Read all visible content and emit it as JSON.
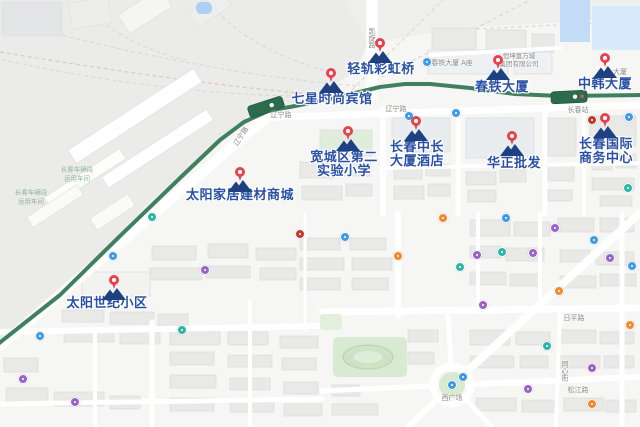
{
  "map": {
    "colors": {
      "poi_label": "#2a51a4",
      "pin_red": "#e8414d",
      "pin_navy": "#1e4182",
      "transit_line": "#41805f",
      "station_fill": "#2c6b4e",
      "water": "#c3dcf5",
      "park": "#d9ead2",
      "road_label": "#8b8b8b",
      "rail_area_label": "#8fb3a6",
      "dot_blue": "#3f9ce2",
      "dot_purple": "#9a63c9",
      "dot_teal": "#2cb6a5",
      "dot_orange": "#ef8a2e",
      "dot_red": "#c0392b"
    },
    "major_pois": [
      {
        "id": "light-rail-rainbow-bridge",
        "lines": [
          "轻轨彩虹桥"
        ],
        "pin": {
          "x": 380,
          "y": 51
        },
        "label": {
          "x": 381,
          "y": 62
        }
      },
      {
        "id": "chuntie-mansion",
        "lines": [
          "春铁大厦"
        ],
        "pin": {
          "x": 498,
          "y": 68
        },
        "label": {
          "x": 502,
          "y": 80
        }
      },
      {
        "id": "zhonghan-mansion",
        "lines": [
          "中韩大厦"
        ],
        "pin": {
          "x": 605,
          "y": 66
        },
        "label": {
          "x": 605,
          "y": 77
        }
      },
      {
        "id": "seven-star-fashion-hotel",
        "lines": [
          "七星时尚宾馆"
        ],
        "pin": {
          "x": 331,
          "y": 81
        },
        "label": {
          "x": 332,
          "y": 92
        }
      },
      {
        "id": "kuancheng-no2-experimental-primary-school",
        "lines": [
          "宽城区第二",
          "实验小学"
        ],
        "pin": {
          "x": 348,
          "y": 139
        },
        "label": {
          "x": 344,
          "y": 150
        }
      },
      {
        "id": "changchun-zhongchang-mansion-hotel",
        "lines": [
          "长春中长",
          "大厦酒店"
        ],
        "pin": {
          "x": 416,
          "y": 129
        },
        "label": {
          "x": 417,
          "y": 140
        }
      },
      {
        "id": "huazheng-wholesale",
        "lines": [
          "华正批发"
        ],
        "pin": {
          "x": 512,
          "y": 144
        },
        "label": {
          "x": 514,
          "y": 156
        }
      },
      {
        "id": "changchun-international-business-center",
        "lines": [
          "长春国际",
          "商务中心"
        ],
        "pin": {
          "x": 605,
          "y": 126
        },
        "label": {
          "x": 606,
          "y": 137
        }
      },
      {
        "id": "taiyang-home-building-materials-mall",
        "lines": [
          "太阳家居建材商城"
        ],
        "pin": {
          "x": 240,
          "y": 180
        },
        "label": {
          "x": 240,
          "y": 188
        }
      },
      {
        "id": "taiyang-century-community",
        "lines": [
          "太阳世纪小区"
        ],
        "pin": {
          "x": 114,
          "y": 288
        },
        "label": {
          "x": 107,
          "y": 296
        }
      }
    ],
    "minor_labels": [
      {
        "text": "辽宁路",
        "x": 281,
        "y": 116
      },
      {
        "text": "辽宁路",
        "x": 242,
        "y": 137,
        "rot": -57
      },
      {
        "text": "辽宁路",
        "x": 396,
        "y": 110
      },
      {
        "text": "凯旋路",
        "x": 371,
        "y": 38,
        "vertical": true
      },
      {
        "text": "长春站",
        "x": 578,
        "y": 111
      },
      {
        "text": "春铁大厦 A座",
        "x": 452,
        "y": 64
      },
      {
        "text": "大厦",
        "x": 620,
        "y": 73
      },
      {
        "text": "西广场",
        "x": 452,
        "y": 399
      },
      {
        "text": "松江路",
        "x": 578,
        "y": 391
      },
      {
        "text": "同心街",
        "x": 564,
        "y": 371,
        "vertical": true
      },
      {
        "text": "日平路",
        "x": 574,
        "y": 319
      },
      {
        "text": "恒坤富万城",
        "x": 519,
        "y": 57,
        "size": 6.5
      },
      {
        "text": "集团有限公司",
        "x": 519,
        "y": 65,
        "size": 6.5
      }
    ],
    "area_labels": [
      {
        "text": "长春车辆段",
        "x": 77,
        "y": 170
      },
      {
        "text": "运用车间",
        "x": 77,
        "y": 179
      },
      {
        "text": "长春车辆段",
        "x": 31,
        "y": 193
      },
      {
        "text": "运用车间",
        "x": 31,
        "y": 202
      }
    ],
    "minor_pois": [
      {
        "color": "dot_blue",
        "x": 427,
        "y": 62
      },
      {
        "color": "dot_blue",
        "x": 409,
        "y": 116
      },
      {
        "color": "dot_blue",
        "x": 456,
        "y": 113
      },
      {
        "color": "dot_blue",
        "x": 629,
        "y": 117
      },
      {
        "color": "dot_blue",
        "x": 113,
        "y": 256
      },
      {
        "color": "dot_blue",
        "x": 40,
        "y": 336
      },
      {
        "color": "dot_blue",
        "x": 345,
        "y": 237
      },
      {
        "color": "dot_blue",
        "x": 506,
        "y": 218
      },
      {
        "color": "dot_blue",
        "x": 594,
        "y": 240
      },
      {
        "color": "dot_blue",
        "x": 632,
        "y": 266
      },
      {
        "color": "dot_blue",
        "x": 463,
        "y": 377
      },
      {
        "color": "dot_blue",
        "x": 452,
        "y": 385
      },
      {
        "color": "dot_purple",
        "x": 205,
        "y": 270
      },
      {
        "color": "dot_purple",
        "x": 23,
        "y": 379
      },
      {
        "color": "dot_purple",
        "x": 75,
        "y": 402
      },
      {
        "color": "dot_purple",
        "x": 477,
        "y": 255
      },
      {
        "color": "dot_purple",
        "x": 533,
        "y": 253
      },
      {
        "color": "dot_purple",
        "x": 483,
        "y": 305
      },
      {
        "color": "dot_purple",
        "x": 555,
        "y": 228
      },
      {
        "color": "dot_purple",
        "x": 528,
        "y": 389
      },
      {
        "color": "dot_purple",
        "x": 592,
        "y": 368
      },
      {
        "color": "dot_purple",
        "x": 610,
        "y": 258
      },
      {
        "color": "dot_teal",
        "x": 152,
        "y": 217
      },
      {
        "color": "dot_teal",
        "x": 502,
        "y": 252
      },
      {
        "color": "dot_teal",
        "x": 460,
        "y": 267
      },
      {
        "color": "dot_teal",
        "x": 182,
        "y": 330
      },
      {
        "color": "dot_teal",
        "x": 547,
        "y": 346
      },
      {
        "color": "dot_teal",
        "x": 628,
        "y": 188
      },
      {
        "color": "dot_orange",
        "x": 443,
        "y": 218
      },
      {
        "color": "dot_orange",
        "x": 398,
        "y": 256
      },
      {
        "color": "dot_orange",
        "x": 559,
        "y": 291
      },
      {
        "color": "dot_orange",
        "x": 630,
        "y": 325
      },
      {
        "color": "dot_orange",
        "x": 592,
        "y": 404
      },
      {
        "color": "dot_red",
        "x": 592,
        "y": 120
      },
      {
        "color": "dot_red",
        "x": 300,
        "y": 234
      }
    ]
  }
}
